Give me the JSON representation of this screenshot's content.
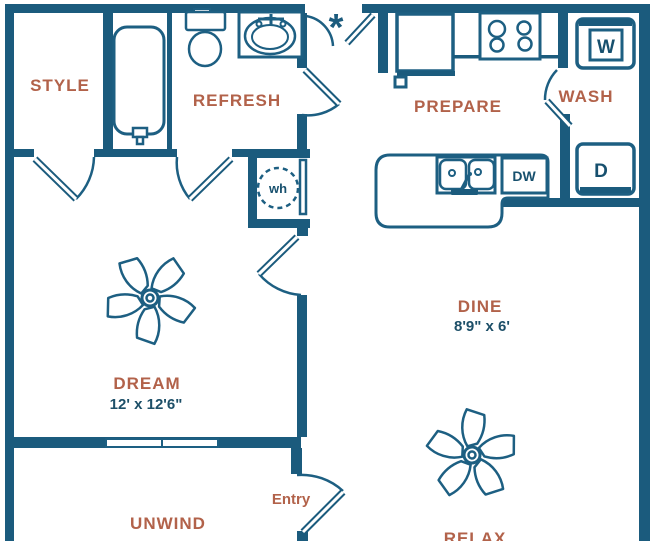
{
  "title": "One bedroom apartment floor plan",
  "colors": {
    "wall": "#1b5b7d",
    "line": "#1d5f82",
    "room_label": "#b2624a",
    "dimension_text": "#1d4f68",
    "appliance_text": "#17506e",
    "background": "#ffffff"
  },
  "rooms": {
    "style": {
      "label": "STYLE"
    },
    "refresh": {
      "label": "REFRESH"
    },
    "prepare": {
      "label": "PREPARE"
    },
    "wash": {
      "label": "WASH"
    },
    "dream": {
      "label": "DREAM",
      "dimensions": "12' x 12'6\""
    },
    "dine": {
      "label": "DINE",
      "dimensions": "8'9\" x 6'"
    },
    "unwind": {
      "label": "UNWIND"
    },
    "relax": {
      "label": "RELAX"
    }
  },
  "annotations": {
    "entry": "Entry",
    "water_heater": "wh",
    "dishwasher": "DW",
    "washer": "W",
    "dryer": "D",
    "note_marker": "*"
  }
}
